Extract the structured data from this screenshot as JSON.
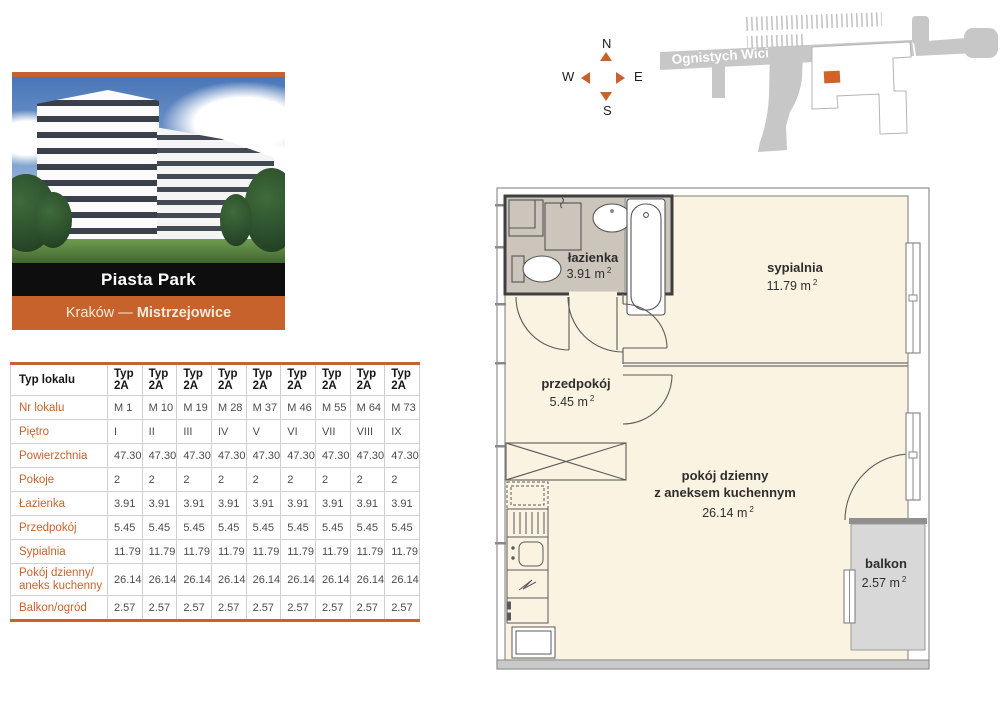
{
  "card": {
    "title": "Piasta Park",
    "location_prefix": "Kraków — ",
    "location_bold": "Mistrzejowice"
  },
  "compass": {
    "n": "N",
    "e": "E",
    "s": "S",
    "w": "W"
  },
  "map": {
    "street": "Ognistych Wici"
  },
  "table": {
    "rows": [
      {
        "label": "Typ lokalu",
        "header": true,
        "values": [
          "Typ 2A",
          "Typ 2A",
          "Typ 2A",
          "Typ 2A",
          "Typ 2A",
          "Typ 2A",
          "Typ 2A",
          "Typ 2A",
          "Typ 2A"
        ]
      },
      {
        "label": "Nr lokalu",
        "values": [
          "M 1",
          "M 10",
          "M 19",
          "M 28",
          "M 37",
          "M 46",
          "M 55",
          "M 64",
          "M 73"
        ]
      },
      {
        "label": "Piętro",
        "values": [
          "I",
          "II",
          "III",
          "IV",
          "V",
          "VI",
          "VII",
          "VIII",
          "IX"
        ]
      },
      {
        "label": "Powierzchnia",
        "values": [
          "47.30",
          "47.30",
          "47.30",
          "47.30",
          "47.30",
          "47.30",
          "47.30",
          "47.30",
          "47.30"
        ]
      },
      {
        "label": "Pokoje",
        "values": [
          "2",
          "2",
          "2",
          "2",
          "2",
          "2",
          "2",
          "2",
          "2"
        ]
      },
      {
        "label": "Łazienka",
        "values": [
          "3.91",
          "3.91",
          "3.91",
          "3.91",
          "3.91",
          "3.91",
          "3.91",
          "3.91",
          "3.91"
        ]
      },
      {
        "label": "Przedpokój",
        "values": [
          "5.45",
          "5.45",
          "5.45",
          "5.45",
          "5.45",
          "5.45",
          "5.45",
          "5.45",
          "5.45"
        ]
      },
      {
        "label": "Sypialnia",
        "values": [
          "11.79",
          "11.79",
          "11.79",
          "11.79",
          "11.79",
          "11.79",
          "11.79",
          "11.79",
          "11.79"
        ]
      },
      {
        "label": "Pokój dzienny/",
        "label2": "aneks kuchenny",
        "values": [
          "26.14",
          "26.14",
          "26.14",
          "26.14",
          "26.14",
          "26.14",
          "26.14",
          "26.14",
          "26.14"
        ]
      },
      {
        "label": "Balkon/ogród",
        "values": [
          "2.57",
          "2.57",
          "2.57",
          "2.57",
          "2.57",
          "2.57",
          "2.57",
          "2.57",
          "2.57"
        ]
      }
    ]
  },
  "plan": {
    "sup": "2",
    "rooms": {
      "lazienka": {
        "name": "łazienka",
        "area": "3.91 m"
      },
      "sypialnia": {
        "name": "sypialnia",
        "area": "11.79 m"
      },
      "przedpokoj": {
        "name": "przedpokój",
        "area": "5.45 m"
      },
      "pokoj": {
        "name": "pokój dzienny",
        "name2": "z aneksem kuchennym",
        "area": "26.14 m"
      },
      "balkon": {
        "name": "balkon",
        "area": "2.57 m"
      }
    }
  },
  "colors": {
    "accent": "#C8622C",
    "room_fill": "#FAF3E2",
    "bathroom_fill": "#CCC5BC",
    "balcony_fill": "#D8D8D8",
    "wall_dark": "#3F3F3F",
    "map_gray": "#C7C7C7"
  }
}
